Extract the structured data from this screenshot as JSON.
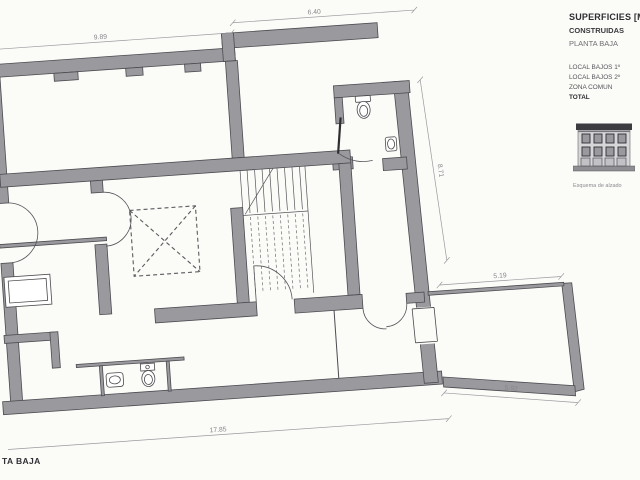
{
  "panel": {
    "title": "SUPERFICIES [M",
    "line2": "CONSTRUIDAS",
    "line3": "PLANTA BAJA",
    "items": [
      "LOCAL BAJOS 1º",
      "LOCAL BAJOS 2º",
      "ZONA COMUN",
      "TOTAL"
    ],
    "elevation_caption": "Esquema de alzado"
  },
  "footer": {
    "title": "TA BAJA"
  },
  "dimensions": {
    "top_left": "9.89",
    "top_right": "6.40",
    "right": "8.71",
    "courtyard_top": "5.19",
    "courtyard_bottom": "5.92",
    "bottom": "17.85"
  },
  "colors": {
    "wall_fill": "#9a999e",
    "wall_outline": "#4b4b50",
    "dimension": "#87878b",
    "background": "#fbfbf8",
    "roof_dark": "#3c3c40"
  }
}
